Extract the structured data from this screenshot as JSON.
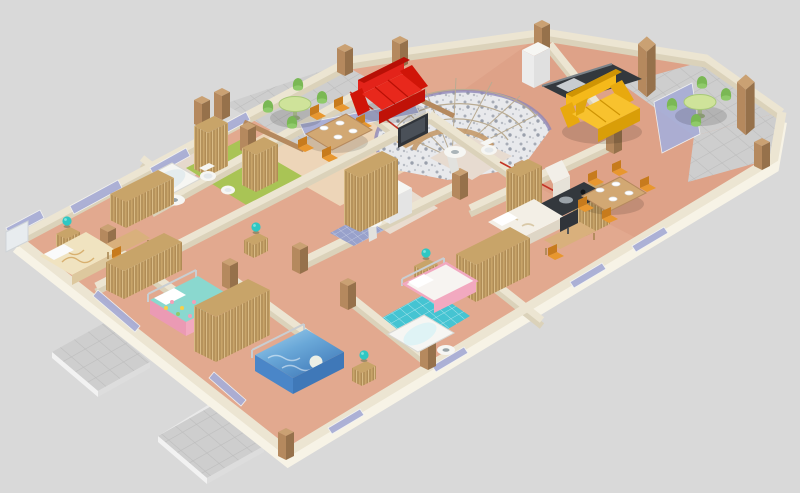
{
  "scene": {
    "type": "3d-isometric-floor-plan",
    "description": "3D cutaway render of an apartment floor plan viewed from above at an angle, on a plain light gray background. Cream cut walls, salmon wood floors, two gray tiled terraces with round green tables, a curved mosaic entrance stair, red and yellow sofas, wicker wardrobes, five bedrooms with patterned beds, green and turquoise tiled bathrooms, and a dark kitchen counter."
  },
  "palette": {
    "background": "#d9d9d9",
    "floor": "#e2a98f",
    "floor_light": "#eed9bd",
    "floor_dark": "#d99a81",
    "wall_top": "#ece5d2",
    "wall_face": "#dbd2ba",
    "wall_face_bright": "#f7f3e6",
    "glass": "#a9aed6",
    "wood": "#b5895e",
    "wood_light": "#caa173",
    "wood_dark": "#96714b",
    "wicker": "#c8a469",
    "wicker_dark": "#a5824e",
    "terrace_tile": "#cecece",
    "terrace_line": "#bdbdbd",
    "green_floor": "#a9c455",
    "blue_tile": "#45c4d2",
    "mat_blue": "#98a1cb",
    "mosaic": "#e8e9ec",
    "mosaic_rim": "#8f87b8",
    "sofa_red": "#e3231a",
    "sofa_red_dark": "#b81006",
    "sofa_yellow": "#f5b91a",
    "sofa_yellow_dark": "#cf9404",
    "table_green": "#cfe39a",
    "chair_green": "#8fca6a",
    "chair_green_dark": "#7ab854",
    "chair_orange": "#e8972f",
    "chair_orange_dark": "#c77b1d",
    "lamp_teal": "#2fc7c3",
    "fixture": "#f6f6f3",
    "fixture_shadow": "#e2e2de",
    "counter_dark": "#33383d",
    "tv_dark": "#30343a",
    "bed_cream": "#f0e3c0",
    "bed_teal": "#8ad8cf",
    "bed_pink": "#f2a9c0",
    "bed_blue_deep": "#3f78b8",
    "bed_blue_sky": "#a8d4ee",
    "bed_white": "#f3efe6",
    "trim_red": "#c23326"
  },
  "rooms": [
    {
      "name": "terrace-left",
      "floor": "gray tiles",
      "furniture": [
        "round green table",
        "four green chairs"
      ]
    },
    {
      "name": "living-dining-left",
      "floor": "light wood",
      "furniture": [
        "red sofa",
        "flat tv",
        "wooden dining table",
        "orange chairs",
        "white plates"
      ]
    },
    {
      "name": "entrance-hall",
      "floor": "stone mosaic",
      "furniture": [
        "curved fan staircase",
        "purple rim",
        "two tall wicker cabinets"
      ]
    },
    {
      "name": "living-right",
      "floor": "salmon wood",
      "furniture": [
        "yellow sofa",
        "dark kitchen counter",
        "fridge",
        "dining table with plates",
        "orange chairs",
        "glass terrace door"
      ]
    },
    {
      "name": "terrace-right",
      "floor": "gray tiles",
      "furniture": [
        "round green table",
        "four green chairs",
        "wood pillars"
      ]
    },
    {
      "name": "bathroom-green",
      "floor": "green",
      "furniture": [
        "bathtub",
        "round washbasin",
        "toilet",
        "bidet"
      ]
    },
    {
      "name": "bathroom-laundry",
      "floor": "pale tile",
      "furniture": [
        "washing machine",
        "pedestal sink",
        "blue checkered mat"
      ]
    },
    {
      "name": "bathroom-top",
      "floor": "pale tile",
      "furniture": [
        "pedestal sink",
        "toilet"
      ]
    },
    {
      "name": "bathroom-turquoise",
      "floor": "turquoise tiles",
      "furniture": [
        "bathtub",
        "washbasin"
      ]
    },
    {
      "name": "bedroom-far-left",
      "furniture": [
        "cream patterned bed",
        "nightstand",
        "teal lamp",
        "desk",
        "orange chair",
        "wicker wardrobe",
        "white tv"
      ]
    },
    {
      "name": "bedroom-front-left",
      "furniture": [
        "teal bed with pink floral skirt",
        "wicker wardrobe",
        "nightstand",
        "teal lamp"
      ]
    },
    {
      "name": "bedroom-front-center",
      "furniture": [
        "blue ocean-print bed with moon",
        "large wicker wardrobe",
        "nightstand",
        "teal lamp"
      ]
    },
    {
      "name": "bedroom-right-top",
      "furniture": [
        "white double bed",
        "desk with monitor",
        "orange chair",
        "wicker wardrobe"
      ]
    },
    {
      "name": "bedroom-right-bottom",
      "furniture": [
        "pink and white bed",
        "wicker wardrobe",
        "teal lamp nightstand"
      ]
    },
    {
      "name": "outdoor",
      "furniture": [
        "two gray tiled patios"
      ]
    }
  ]
}
